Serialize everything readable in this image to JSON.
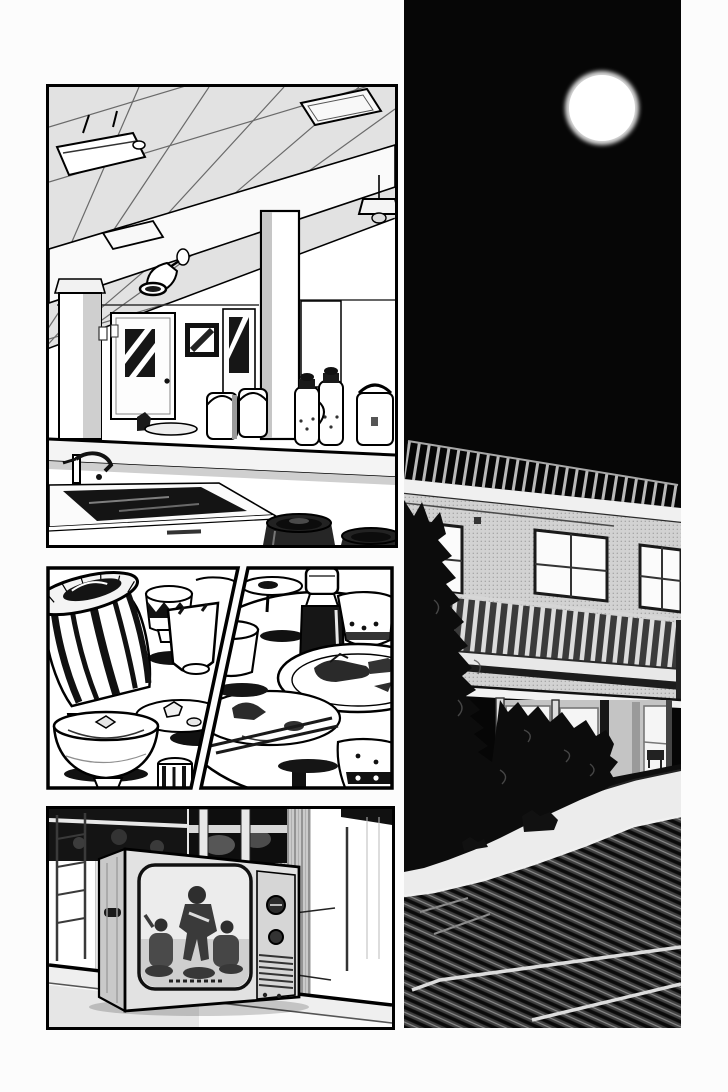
{
  "page": {
    "media": "black-and-white manga page scan",
    "paper_color": "#fcfcfc",
    "ink_color": "#000000",
    "visible_text": "none",
    "panel_count": 5
  },
  "panels": [
    {
      "id": "cafeteria",
      "description": "Empty cafeteria interior: tiled ceiling in perspective, fluorescent light, wall sconce, pendant lamp, columns, doors with striped windows, framed picture, serving counter with rice cookers and water thermoses, foreground sink with faucet and round trash bins"
    },
    {
      "id": "dishes-left",
      "description": "Close-up after a meal: roped wooden cask, patterned cup, overturned cup, plate of scraps and a large bowl with leftovers on a table"
    },
    {
      "id": "dishes-right",
      "description": "Round table with emptied plates, leftover scraps, chopsticks, a dark soy-sauce bottle with white cap, patterned bowls and a white cup"
    },
    {
      "id": "television",
      "description": "Old CRT television set on a ledge, screen showing a period-drama scene with three figures; two dials and a speaker grille on the right side"
    },
    {
      "id": "night-building",
      "description": "Tall night panel: full moon in a black sky over a two-story dormitory with rooftop railing, lit windows, balcony, entrance porch, dark garden bushes and a hatched driveway with pale lane markings"
    }
  ],
  "colors": {
    "night_sky": "#060606",
    "moon": "#ffffff",
    "building_facade": "#d2d2d2",
    "ink": "#000000",
    "paper": "#fcfcfc"
  }
}
